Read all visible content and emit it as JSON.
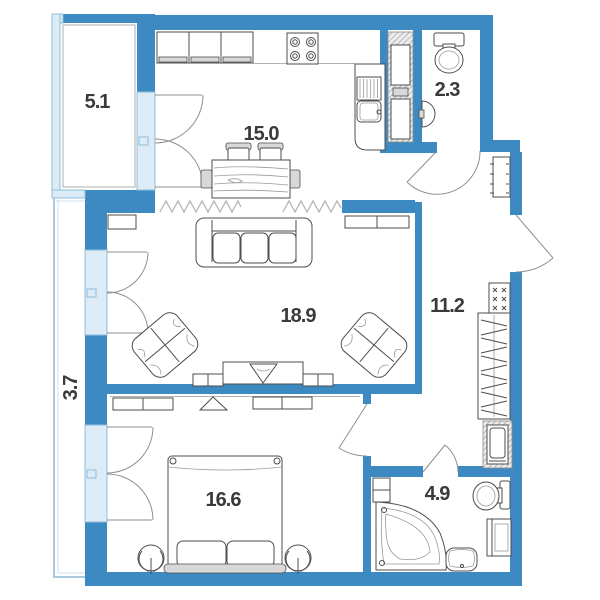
{
  "plan": {
    "rooms": {
      "balcony": "5.1",
      "kitchen": "15.0",
      "wc": "2.3",
      "living": "18.9",
      "hall": "11.2",
      "loggia": "3.7",
      "bedroom": "16.6",
      "bathroom": "4.9"
    },
    "colors": {
      "wall": "#3c8ac1",
      "glazing_fill": "#dcebf6",
      "glazing_stroke": "#8fbddc",
      "loggia_stroke": "#aac8de",
      "line": "#4d4d4d",
      "line_soft": "#9a9a9a",
      "fill_gray": "#d8d8d8",
      "label": "#3a3a3a",
      "bg": "#ffffff"
    }
  }
}
